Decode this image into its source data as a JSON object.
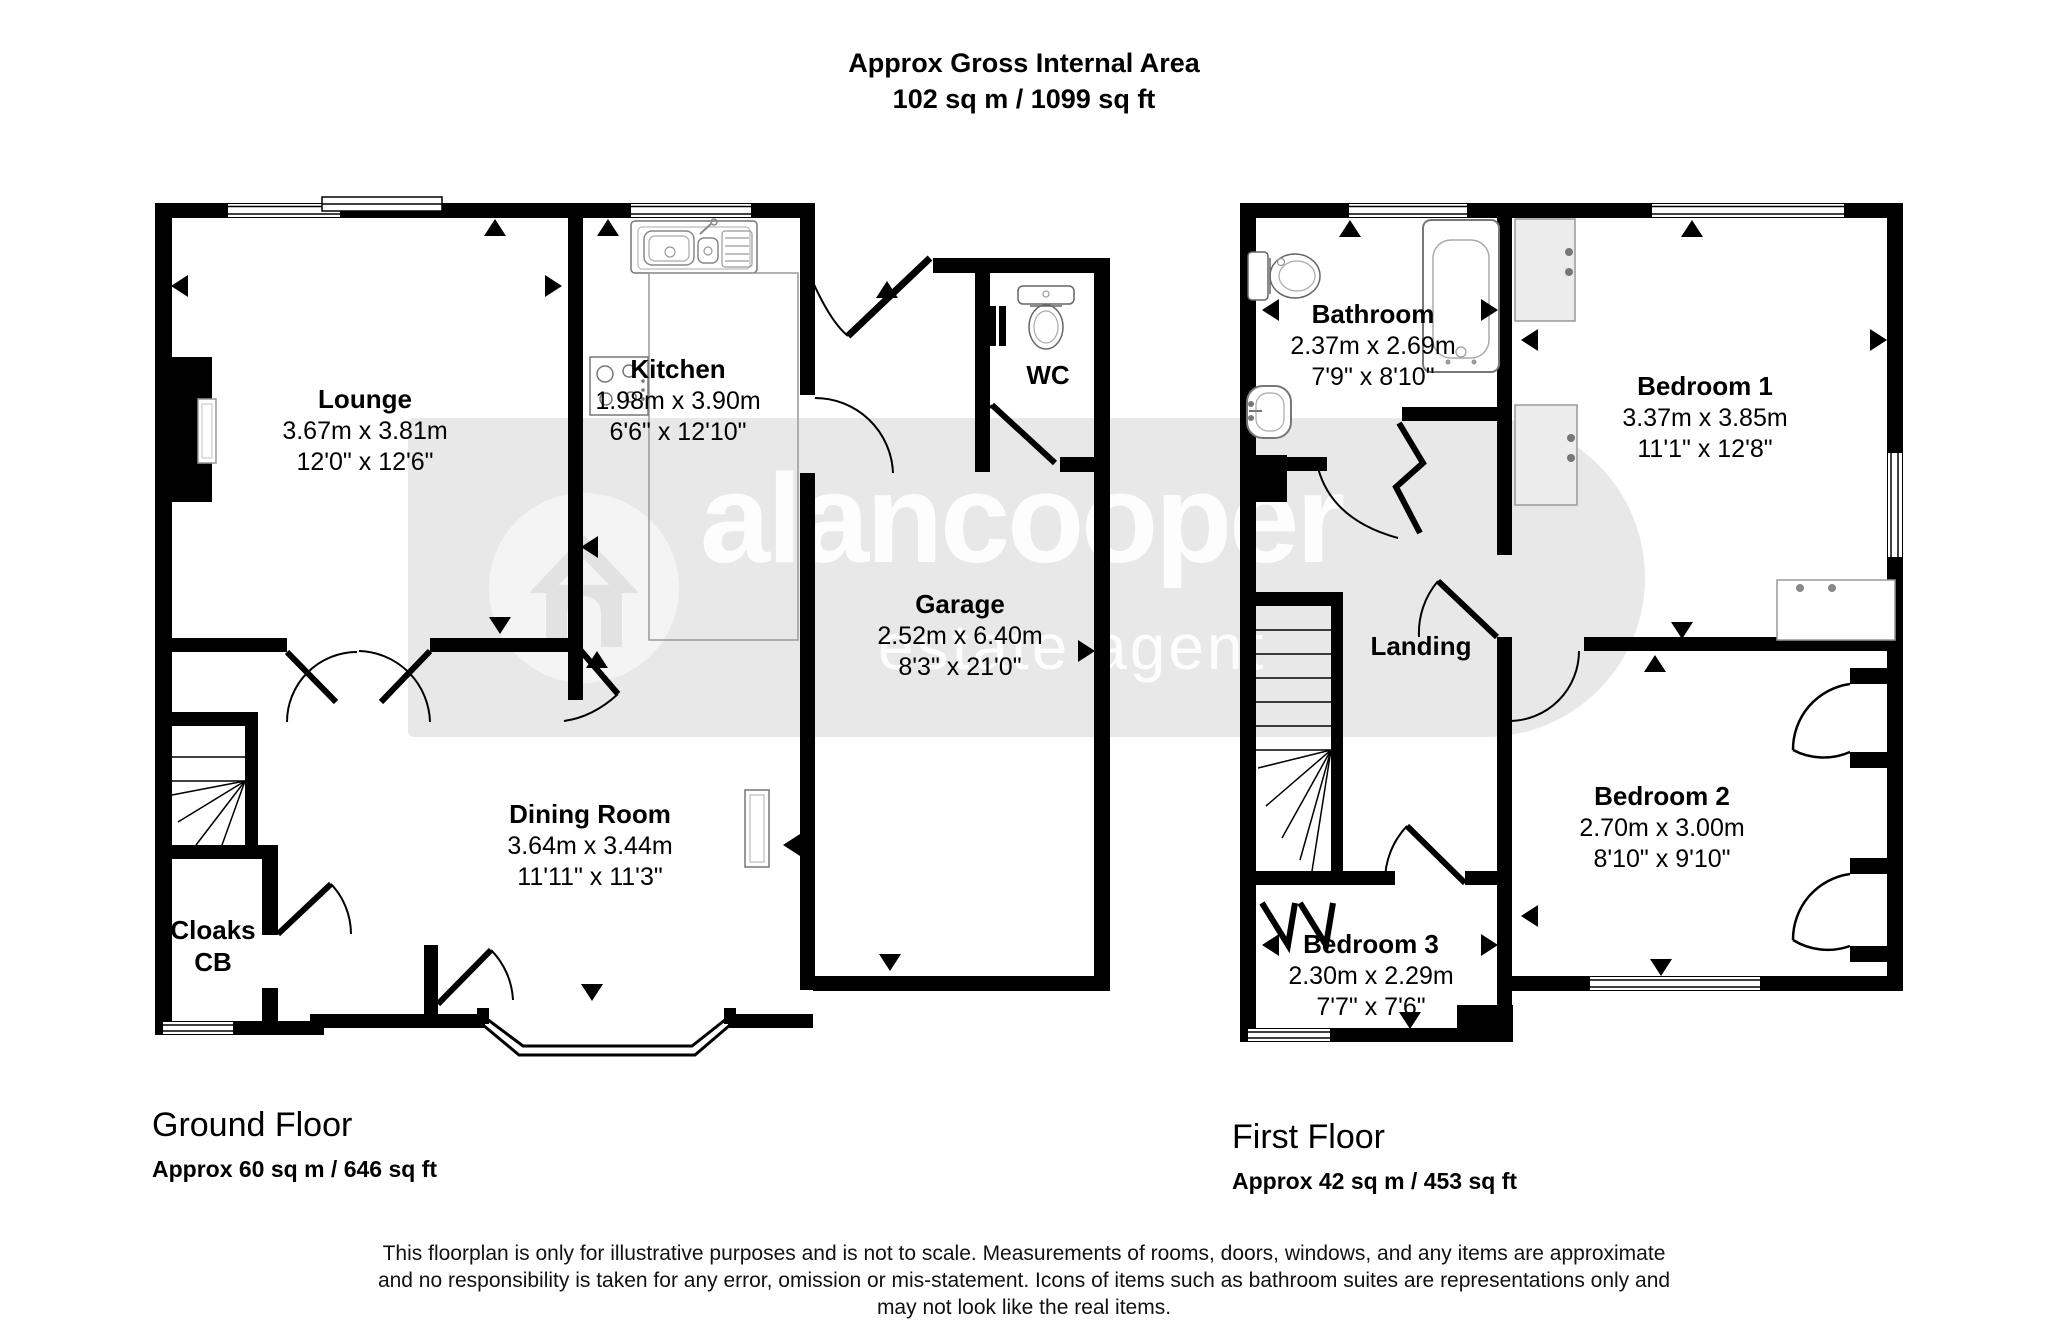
{
  "title": {
    "line1": "Approx Gross Internal Area",
    "line2": "102 sq m / 1099 sq ft"
  },
  "watermark": {
    "brand": "alancooper",
    "tagline": "estate agent"
  },
  "ground_floor": {
    "label": "Ground Floor",
    "area": "Approx 60 sq m / 646 sq ft",
    "rooms": {
      "lounge": {
        "name": "Lounge",
        "metric": "3.67m x 3.81m",
        "imperial": "12'0\" x 12'6\""
      },
      "kitchen": {
        "name": "Kitchen",
        "metric": "1.98m x 3.90m",
        "imperial": "6'6\" x 12'10\""
      },
      "wc": {
        "name": "WC"
      },
      "garage": {
        "name": "Garage",
        "metric": "2.52m x 6.40m",
        "imperial": "8'3\" x 21'0\""
      },
      "dining": {
        "name": "Dining Room",
        "metric": "3.64m x 3.44m",
        "imperial": "11'11\" x 11'3\""
      },
      "cloaks": {
        "name": "Cloaks",
        "line2": "CB"
      }
    }
  },
  "first_floor": {
    "label": "First Floor",
    "area": "Approx 42 sq m / 453 sq ft",
    "rooms": {
      "bathroom": {
        "name": "Bathroom",
        "metric": "2.37m x 2.69m",
        "imperial": "7'9\" x 8'10\""
      },
      "bedroom1": {
        "name": "Bedroom 1",
        "metric": "3.37m x 3.85m",
        "imperial": "11'1\" x 12'8\""
      },
      "landing": {
        "name": "Landing"
      },
      "bedroom2": {
        "name": "Bedroom 2",
        "metric": "2.70m x 3.00m",
        "imperial": "8'10\" x 9'10\""
      },
      "bedroom3": {
        "name": "Bedroom 3",
        "metric": "2.30m x 2.29m",
        "imperial": "7'7\" x 7'6\""
      }
    }
  },
  "disclaimer": {
    "line1": "This floorplan is only for illustrative purposes and is not to scale. Measurements of rooms, doors, windows, and any items are approximate",
    "line2": "and no responsibility is taken for any error, omission or mis-statement. Icons of items such as bathroom suites are representations only and",
    "line3": "may not look like the real items."
  }
}
